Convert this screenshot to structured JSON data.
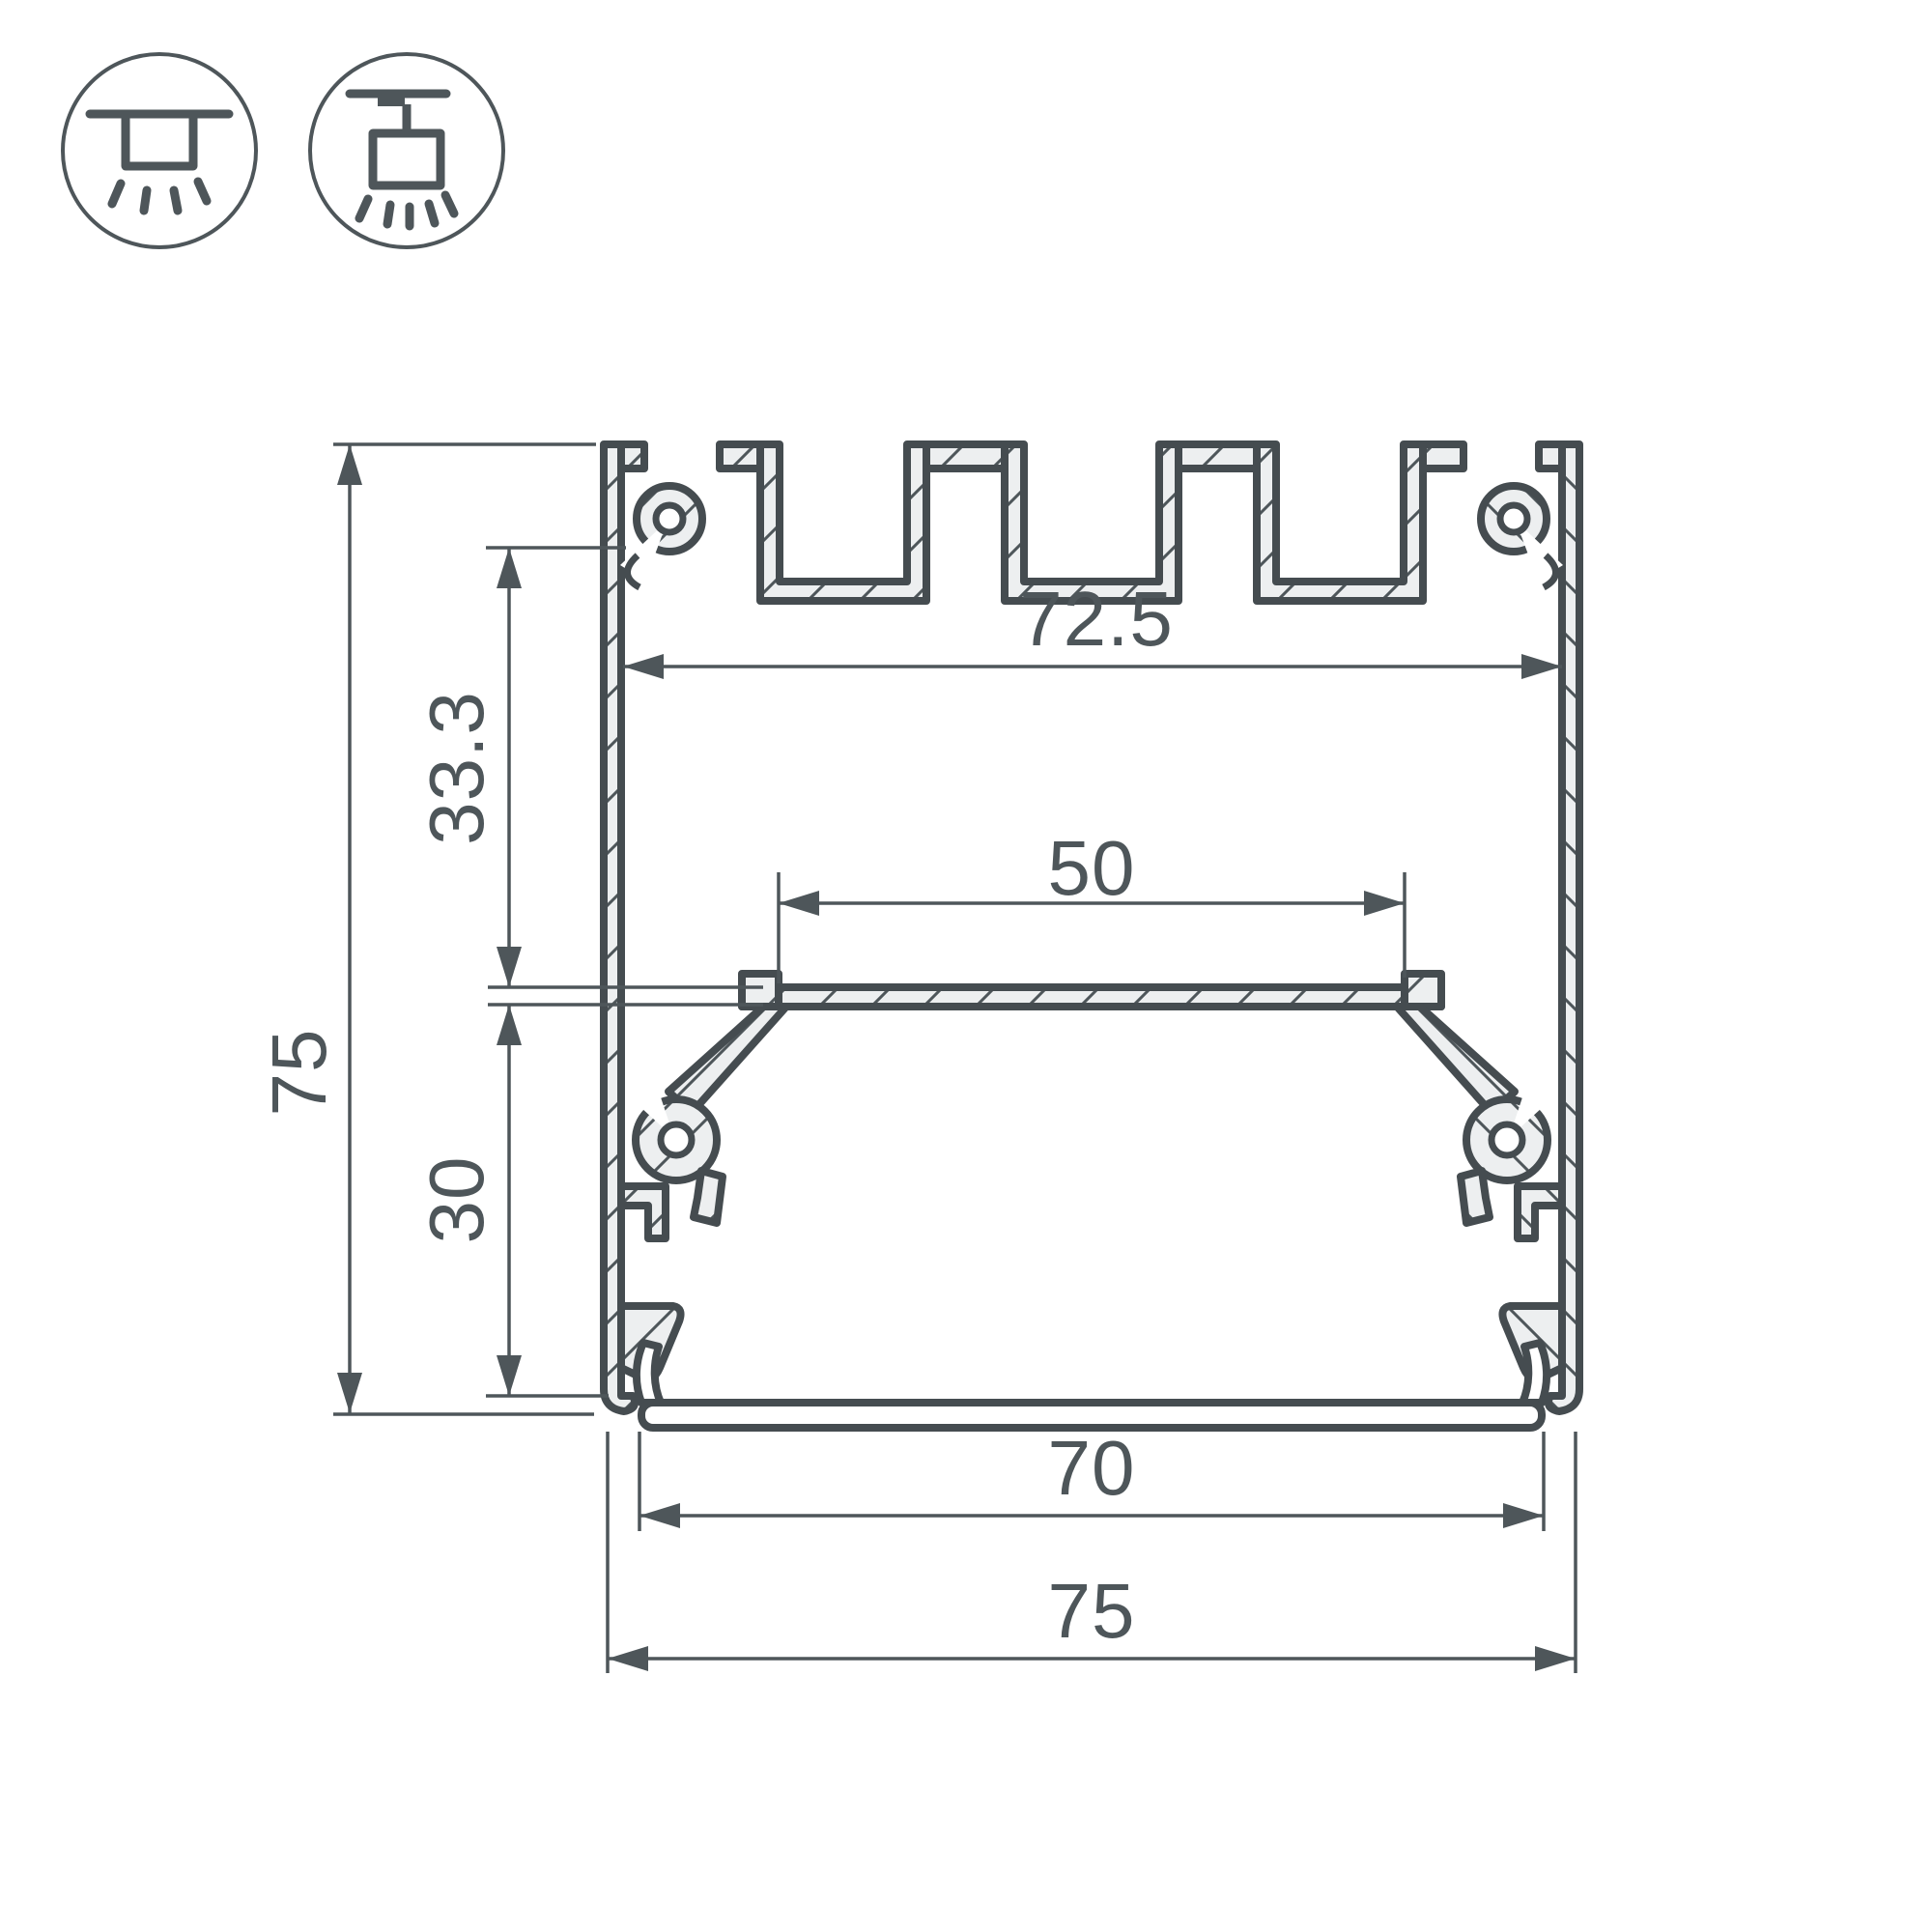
{
  "drawing": {
    "line_color": "#4e565a",
    "aluminum_fill": "#edeff0",
    "background": "#ffffff",
    "dimensions": {
      "inner_width_top": "72.5",
      "vertical_upper": "33.3",
      "overall_height": "75",
      "platform_width": "50",
      "vertical_lower": "30",
      "bottom_opening": "70",
      "overall_width": "75"
    },
    "mount_icons": [
      {
        "name": "surface-ceiling-mount-icon"
      },
      {
        "name": "suspended-pendant-mount-icon"
      }
    ]
  }
}
